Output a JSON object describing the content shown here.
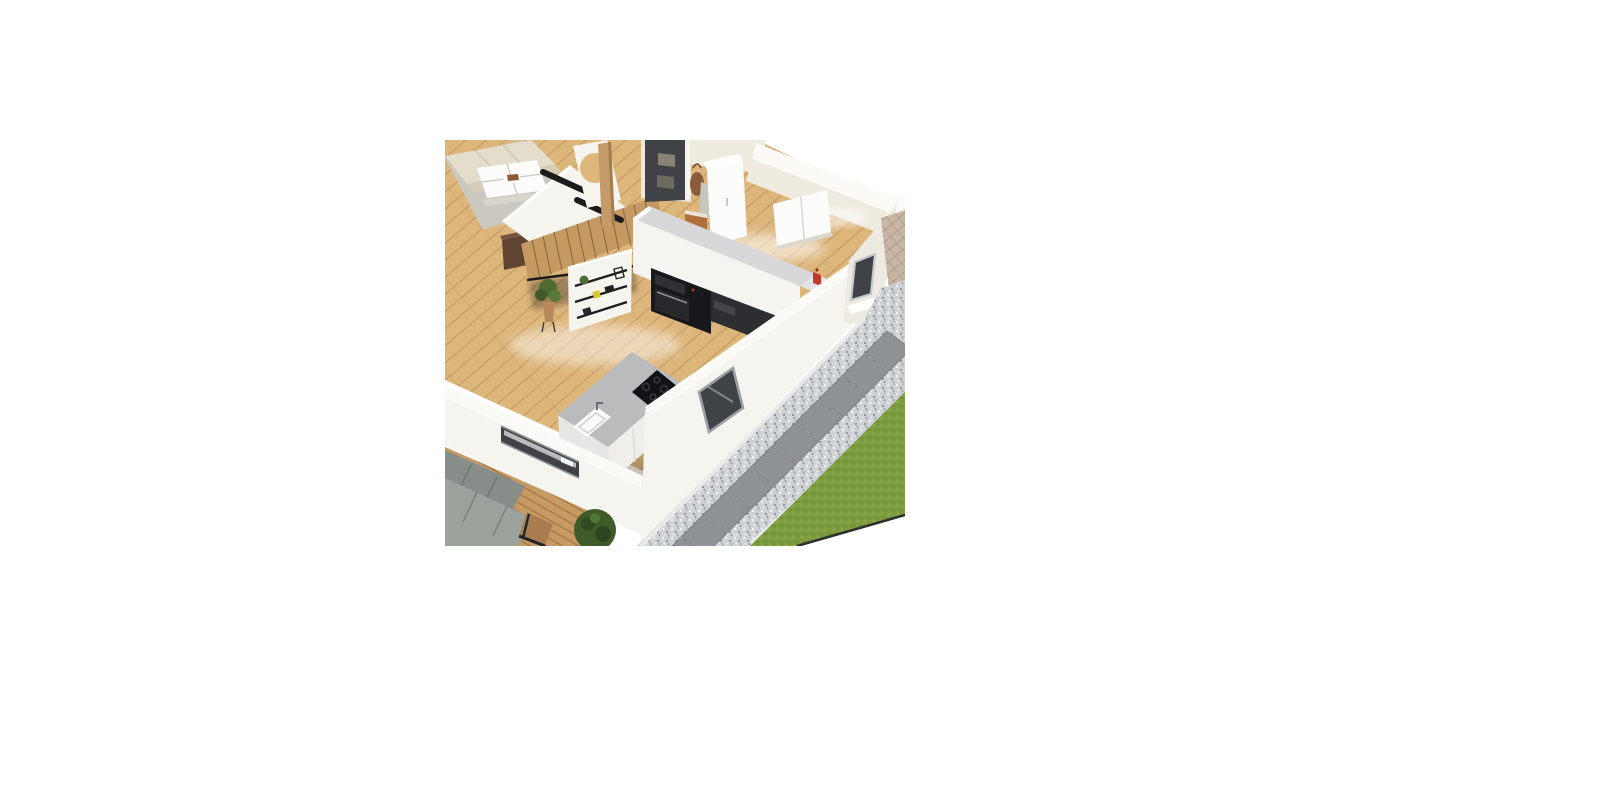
{
  "page": {
    "background": "#ffffff",
    "description": "3D isometric floor plan render of a house ground floor on a blank white canvas"
  },
  "viewport": {
    "x": 445,
    "y": 140,
    "width": 460,
    "height": 406,
    "label": "3D home design perspective render"
  },
  "scene": {
    "rooms": [
      "living-room",
      "staircase-hall",
      "entry",
      "kitchen",
      "terrace-deck",
      "garden"
    ],
    "objects": [
      {
        "name": "living-sofa",
        "desc": "beige sofa, partially cut by render edge"
      },
      {
        "name": "coffee-table",
        "desc": "white square coffee table with tray and brown book"
      },
      {
        "name": "area-rug",
        "desc": "light gray rug"
      },
      {
        "name": "sideboard",
        "desc": "dark brown low cabinet beside stairs"
      },
      {
        "name": "staircase",
        "desc": "wooden stairs with black handrails"
      },
      {
        "name": "wall-round-opening",
        "desc": "white wall with circular cutout and wood post"
      },
      {
        "name": "entry-door",
        "desc": "dark charcoal front door with two lighter panels"
      },
      {
        "name": "hanging-bag",
        "desc": "brown shoulder bag on wall hook"
      },
      {
        "name": "entry-console",
        "desc": "small orange-wood console"
      },
      {
        "name": "wardrobe",
        "desc": "tall white entry wardrobe"
      },
      {
        "name": "wall-cabinet",
        "desc": "white two-door cabinet on back wall"
      },
      {
        "name": "kitchen-tall-units",
        "desc": "white kitchen run with gray top and built-in black oven / appliances"
      },
      {
        "name": "kitchen-dark-counter",
        "desc": "dark lower counter section"
      },
      {
        "name": "red-accessories",
        "desc": "small red appliances at counter end near corner window"
      },
      {
        "name": "shelf-wall",
        "desc": "half wall with black shelves, plant, yellow and black objects"
      },
      {
        "name": "floor-plant",
        "desc": "potted green plant on stand"
      },
      {
        "name": "kitchen-island",
        "desc": "island with gray worktop, white base, black induction hob, white sink"
      },
      {
        "name": "front-window",
        "desc": "dark window strip in low front wall"
      },
      {
        "name": "side-window",
        "desc": "window in wall along garden path"
      },
      {
        "name": "corner-window",
        "desc": "small window at kitchen corner"
      },
      {
        "name": "gravel-path",
        "desc": "white gravel band with square stepping stones"
      },
      {
        "name": "lawn",
        "desc": "green grass strip"
      },
      {
        "name": "paver-patio",
        "desc": "tan paver area at top right"
      },
      {
        "name": "wood-deck",
        "desc": "plank deck outside front wall"
      },
      {
        "name": "outdoor-sofa",
        "desc": "gray outdoor sofa with black frame and wood armrest"
      },
      {
        "name": "boxwood-bush",
        "desc": "round dark green shrub"
      }
    ],
    "stepping_stone_count": 9,
    "palette": {
      "canvas": "#ffffff",
      "woodFloor": "#ddb67c",
      "woodDeck": "#c79a63",
      "woodStairs": "#c59a62",
      "woodPost": "#c49a66",
      "wallLit": "#f6f4ee",
      "wallShade": "#edeae1",
      "wallTop": "#fbfaf6",
      "wallWarm": "#f0ebe0",
      "rug": "#cbc8c2",
      "sofaBeige": "#e4ddcb",
      "tableWhite": "#fcfcfb",
      "trayBrown": "#8a5a36",
      "sideboardBrown": "#5f4433",
      "doorDark": "#3f4246",
      "doorPanel": "#8a8274",
      "bagBrown": "#8a5c3c",
      "consoleWood": "#b0703c",
      "counterTop": "#d8d8da",
      "counterWhite": "#f5f4f1",
      "applianceBlack": "#17181b",
      "counterDark": "#2c2e31",
      "islandTop": "#b9bbbd",
      "islandWhite": "#efeeeb",
      "cooktopBlack": "#121316",
      "sinkWhite": "#fafafa",
      "accentRed": "#c0392b",
      "plantGreen": "#4e6b33",
      "bushGreen": "#3f5b2a",
      "grass": "#7d9c40",
      "gravel": "#ced2d5",
      "stone": "#8f9296",
      "edging": "#eef0f2",
      "paver": "#c9b6a4",
      "windowDark": "#3f4347",
      "frameGray": "#9aa0a5",
      "railBlack": "#1b1b1d"
    }
  }
}
